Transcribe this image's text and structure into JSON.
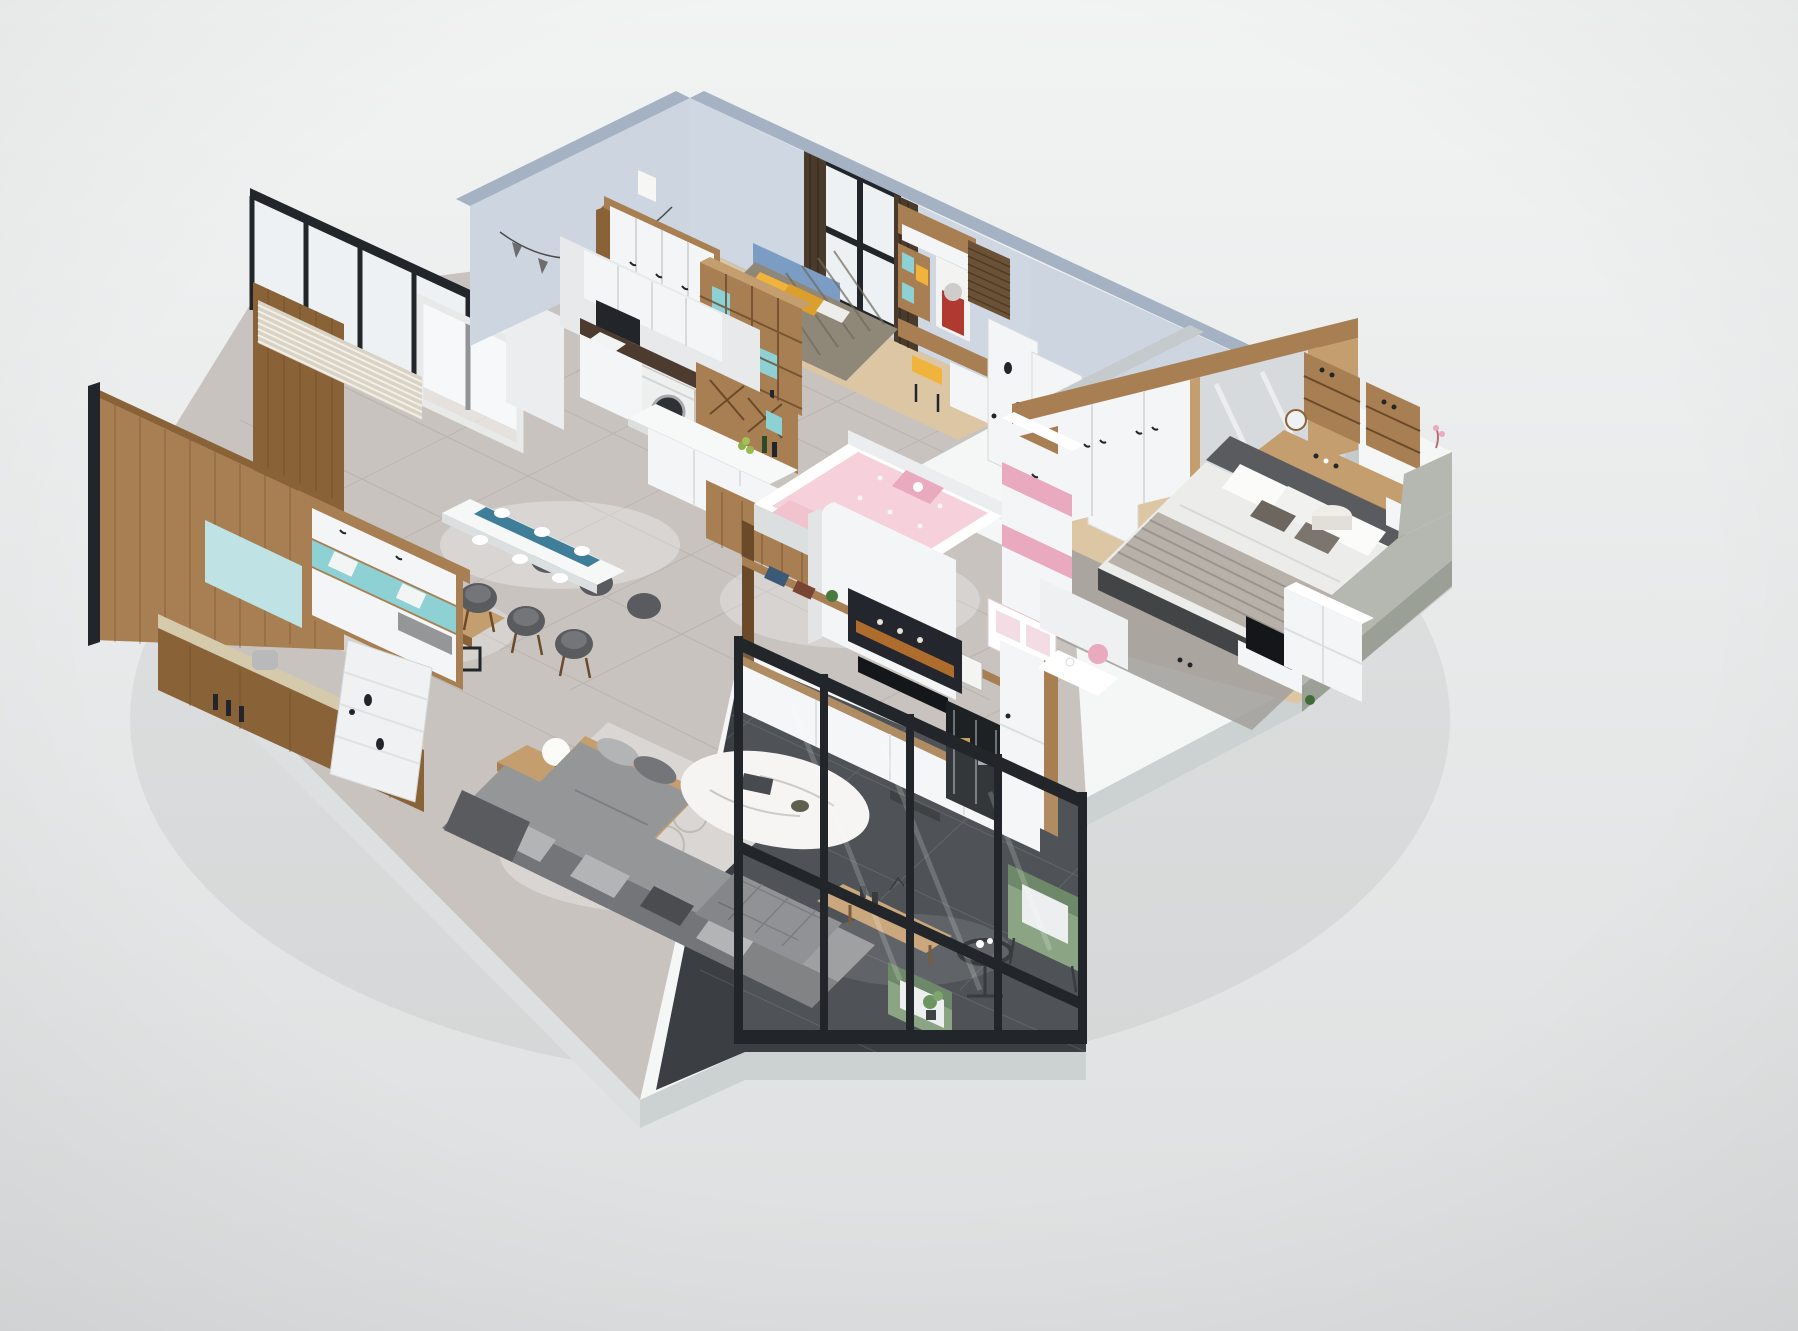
{
  "scene": {
    "type": "3d-isometric-apartment-floorplan-render",
    "palette": {
      "bgTop": "#f1f2f2",
      "bgBot": "#dedfe0",
      "plinthTop": "#f5f6f6",
      "plinthSide": "#ccd1d2",
      "plinthSide2": "#dce0e1",
      "marble": "#c8c3bf",
      "marbleLine": "#a59f9a",
      "darkTile": "#3b3f43",
      "darkLine": "#5a5e62",
      "woodFloor": "#dcc6a4",
      "wood": "#a87f52",
      "woodDark": "#8a6238",
      "woodDeep": "#6b4a2a",
      "woodLight": "#c49e6e",
      "woodPale": "#dec29b",
      "white": "#f4f5f6",
      "whiteWarm": "#ebedee",
      "whiteShade": "#dcdfe0",
      "slate": "#a5b2c4",
      "slateFace": "#ccd5e0",
      "wallGray": "#c5cacd",
      "black": "#22262a",
      "glass": "#eef1f3",
      "teal": "#8ed1d5",
      "tealSoft": "#bfe3e5",
      "yellow": "#f0b43c",
      "yellow2": "#dd9f2b",
      "blue": "#7c9dc3",
      "pink": "#f6d0da",
      "pinkDeep": "#e9a9bf",
      "pinkSoft": "#f3dce3",
      "sofa": "#959698",
      "sofaDark": "#747578",
      "sofaDeep": "#5a5b5e",
      "sofaLight": "#b3b4b6",
      "green": "#7e9b77",
      "greenDark": "#5e7c58",
      "curtain": "#4a3a2b",
      "beige": "#d5caab",
      "counterDark": "#4e3b2f",
      "rug": "#a3a09d",
      "rugLight": "#d9d6d3",
      "bay": "#b4b8b0",
      "baySide": "#9aa096",
      "lamp": "#fbfbf8"
    },
    "rooms": [
      {
        "id": "kids-bedroom-boy",
        "furniture": [
          "bed-yellow-pillows",
          "blue-headboard",
          "wardrobe-white",
          "cube-bookshelf",
          "window-black-frame",
          "curtains",
          "bunting-garland"
        ]
      },
      {
        "id": "study-nook",
        "furniture": [
          "desk",
          "yellow-chair",
          "rhino-poster",
          "roller-blind",
          "wall-cabinet"
        ]
      },
      {
        "id": "laundry-kitchen",
        "furniture": [
          "washing-machine",
          "sink-counter",
          "wall-cabinets",
          "wine-lattice-cabinet",
          "island-counter"
        ]
      },
      {
        "id": "dining-area",
        "furniture": [
          "dining-table",
          "table-runner",
          "six-chairs",
          "place-settings"
        ]
      },
      {
        "id": "tea-room",
        "furniture": [
          "wood-panel-walls",
          "tea-table",
          "black-stools",
          "mint-accent-panel",
          "slat-blinds",
          "side-counter"
        ]
      },
      {
        "id": "entry",
        "furniture": [
          "shoe-cabinet",
          "bench-cushion",
          "open-white-door"
        ]
      },
      {
        "id": "hallway",
        "furniture": [
          "white-door-1",
          "white-door-2",
          "white-door-3"
        ]
      },
      {
        "id": "kids-bedroom-pink",
        "furniture": [
          "bed-hello-kitty",
          "pink-white-wardrobe",
          "dollhouse-shelf",
          "white-partition"
        ]
      },
      {
        "id": "master-bedroom",
        "furniture": [
          "double-bed",
          "pillows",
          "striped-throw",
          "wardrobe-mirror",
          "vanity-desk",
          "cosmetic-shelves",
          "pouf",
          "nightstand",
          "rug",
          "tv-low-unit",
          "bay-ledge"
        ]
      },
      {
        "id": "living-room",
        "furniture": [
          "sectional-sofa",
          "tufted-ottoman",
          "chaise-daybed",
          "marble-coffee-table",
          "side-table-lamp",
          "console-bench",
          "tv-wall-unit",
          "movie-poster",
          "display-cabinet"
        ]
      },
      {
        "id": "balcony",
        "furniture": [
          "glazed-metal-partition",
          "green-armchair-1",
          "green-armchair-2",
          "round-side-table",
          "plant"
        ]
      }
    ]
  }
}
